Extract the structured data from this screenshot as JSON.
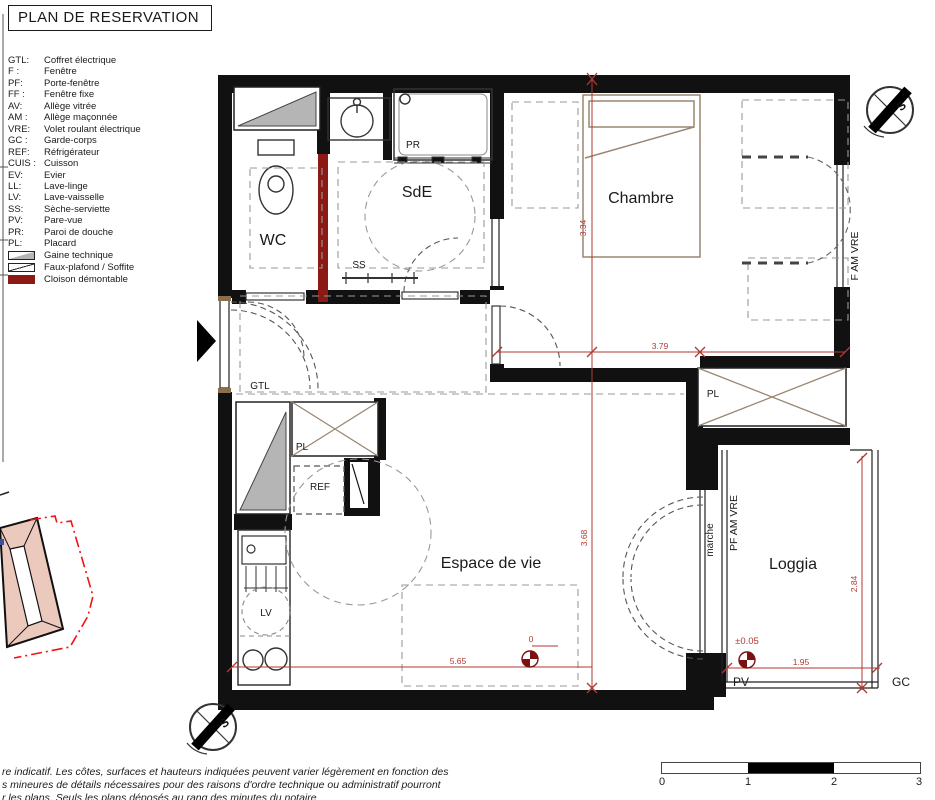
{
  "title": "PLAN DE RESERVATION",
  "legend": {
    "entries": [
      {
        "code": "GTL:",
        "label": "Coffret électrique"
      },
      {
        "code": "F :",
        "label": "Fenêtre"
      },
      {
        "code": "PF:",
        "label": "Porte-fenêtre"
      },
      {
        "code": "FF :",
        "label": "Fenêtre fixe"
      },
      {
        "code": "AV:",
        "label": "Allège vitrée"
      },
      {
        "code": "AM :",
        "label": "Allège maçonnée"
      },
      {
        "code": "VRE:",
        "label": "Volet roulant électrique"
      },
      {
        "code": "GC :",
        "label": "Garde-corps"
      },
      {
        "code": "REF:",
        "label": "Réfrigérateur"
      },
      {
        "code": "CUIS :",
        "label": "Cuisson"
      },
      {
        "code": "EV:",
        "label": "Evier"
      },
      {
        "code": "LL:",
        "label": "Lave-linge"
      },
      {
        "code": "LV:",
        "label": "Lave-vaisselle"
      },
      {
        "code": "SS:",
        "label": "Sèche-serviette"
      },
      {
        "code": "PV:",
        "label": "Pare-vue"
      },
      {
        "code": "PR:",
        "label": "Paroi de douche"
      },
      {
        "code": "PL:",
        "label": "Placard"
      }
    ],
    "symbols": [
      {
        "name": "gaine-technique",
        "label": "Gaine technique"
      },
      {
        "name": "faux-plafond",
        "label": "Faux-plafond / Soffite"
      },
      {
        "name": "cloison-demontable",
        "label": "Cloison démontable"
      }
    ]
  },
  "rooms": {
    "wc": "WC",
    "sde": "SdE",
    "chambre": "Chambre",
    "espace_de_vie": "Espace de vie",
    "loggia": "Loggia"
  },
  "labels": {
    "pr": "PR",
    "ss": "SS",
    "gtl": "GTL",
    "pl_kitchen": "PL",
    "ref": "REF",
    "lv": "LV",
    "pl_chambre": "PL",
    "pv": "PV",
    "gc": "GC",
    "marche": "marche",
    "pf_am_vre": "PF AM VRE",
    "f_am_vre": "F AM VRE"
  },
  "dimensions": {
    "chambre_h": "3.34",
    "chambre_w": "3.79",
    "espace_h": "3.68",
    "espace_w": "5.65",
    "loggia_h": "2.84",
    "loggia_w": "1.95",
    "level_zero": "0",
    "level_loggia": "±0.05"
  },
  "compass": {
    "south_label": "S"
  },
  "scale_bar": {
    "ticks": [
      "0",
      "1",
      "2",
      "3"
    ]
  },
  "disclaimer": {
    "line1": "re indicatif. Les côtes, surfaces et hauteurs indiquées peuvent varier légèrement en fonction des",
    "line2": "s mineures de détails nécessaires pour des raisons d'ordre technique ou administratif pourront",
    "line3": "r les plans. Seuls les plans déposés au rang des minutes du notaire"
  },
  "colors": {
    "wall_black": "#111111",
    "dimension_red": "#b03a32",
    "level_marker_red": "#7a1010",
    "cloison_red": "#8b1a14",
    "gaine_gray": "#b5b5b5",
    "roof_pink": "#ecc9bd",
    "boundary_red": "#f21212"
  }
}
